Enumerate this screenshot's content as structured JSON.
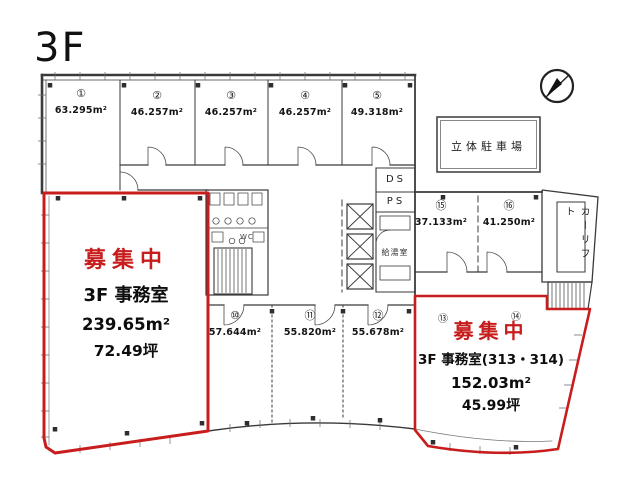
{
  "title": "3F",
  "colors": {
    "red": "#c81d1d",
    "line": "#3a3a3a"
  },
  "rooms": {
    "top": [
      {
        "no": "①",
        "area": "63.295m²"
      },
      {
        "no": "②",
        "area": "46.257m²"
      },
      {
        "no": "③",
        "area": "46.257m²"
      },
      {
        "no": "④",
        "area": "46.257m²"
      },
      {
        "no": "⑤",
        "area": "49.318m²"
      }
    ],
    "mid": [
      {
        "no": "⑮",
        "area": "37.133m²"
      },
      {
        "no": "⑯",
        "area": "41.250m²"
      }
    ],
    "bottom": [
      {
        "no": "⑩",
        "area": "57.644m²"
      },
      {
        "no": "⑪",
        "area": "55.820m²"
      },
      {
        "no": "⑫",
        "area": "55.678m²"
      }
    ],
    "right_markers": [
      "⑬",
      "⑭"
    ]
  },
  "vacancy": {
    "left": {
      "status": "募集中",
      "name": "3F 事務室",
      "area": "239.65m²",
      "tsubo": "72.49坪"
    },
    "right": {
      "status": "募集中",
      "name": "3F 事務室(313・314)",
      "area": "152.03m²",
      "tsubo": "45.99坪"
    }
  },
  "facilities": {
    "parking": "立体駐車場",
    "car_lift": "カーリフト",
    "ds": "DS",
    "ps": "PS",
    "kitchen": "給湯室",
    "wc": "WC"
  }
}
